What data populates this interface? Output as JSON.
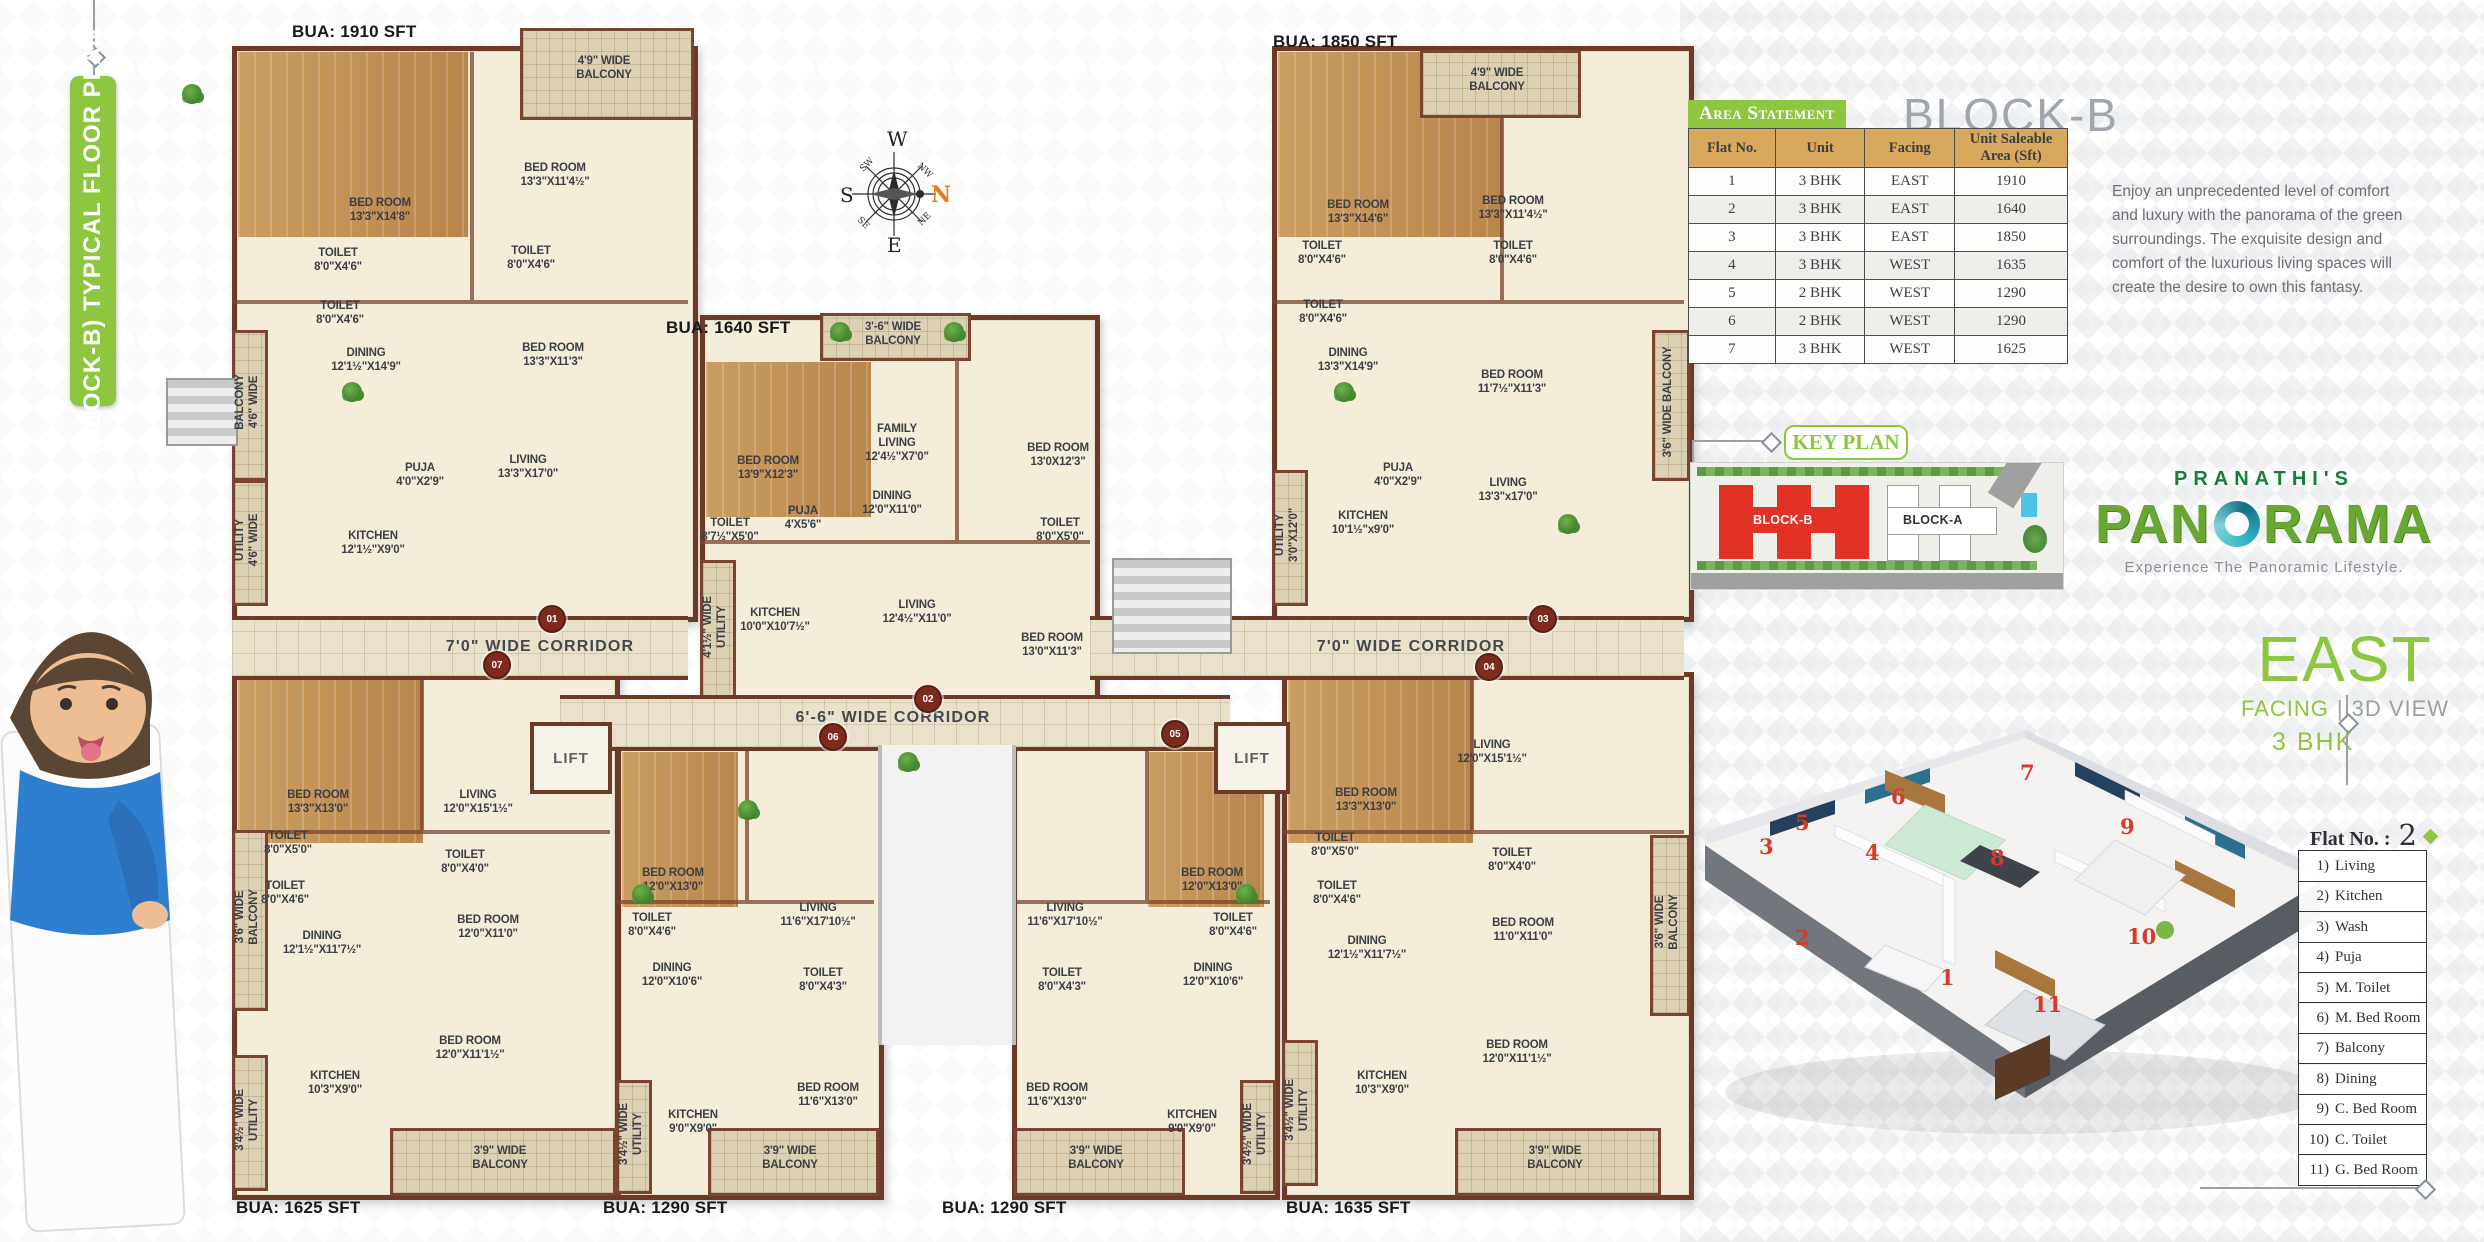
{
  "colors": {
    "accent_green": "#8dc63f",
    "brand_green": "#177e3e",
    "block_red": "#e23125",
    "table_header_tan": "#d8a85c"
  },
  "left_banner": {
    "title": "(BLOCK-B) TYPICAL FLOOR PLAN"
  },
  "compass": {
    "n": "N",
    "s": "S",
    "e": "E",
    "w": "W",
    "nw": "NW",
    "ne": "NE",
    "sw": "SW",
    "se": "SE"
  },
  "floor_plan": {
    "corridors": [
      "7'0\" WIDE CORRIDOR",
      "6'-6\" WIDE CORRIDOR",
      "7'0\" WIDE CORRIDOR"
    ],
    "lift": "LIFT",
    "door_markers": [
      "01",
      "02",
      "03",
      "04",
      "05",
      "06",
      "07"
    ],
    "flats": [
      {
        "bua": "BUA: 1910 SFT",
        "rooms": [
          "4'9\" WIDE\nBALCONY",
          "BED ROOM\n13'3\"X14'8\"",
          "BED ROOM\n13'3\"X11'4½\"",
          "TOILET\n8'0\"X4'6\"",
          "TOILET\n8'0\"X4'6\"",
          "TOILET\n8'0\"X4'6\"",
          "BED ROOM\n13'3\"X11'3\"",
          "DINING\n12'1½\"X14'9\"",
          "BALCONY\n4'6\" WIDE",
          "PUJA\n4'0\"X2'9\"",
          "LIVING\n13'3\"X17'0\"",
          "KITCHEN\n12'1½\"X9'0\"",
          "UTILITY\n4'6\" WIDE"
        ]
      },
      {
        "bua": "BUA: 1640 SFT",
        "rooms": [
          "3'-6\" WIDE\nBALCONY",
          "BED ROOM\n13'9\"X12'3\"",
          "FAMILY\nLIVING\n12'4½\"X7'0\"",
          "BED ROOM\n13'0X12'3\"",
          "TOILET\n8'7½\"X5'0\"",
          "PUJA\n4'X5'6\"",
          "DINING\n12'0\"X11'0\"",
          "TOILET\n8'0\"X5'0\"",
          "KITCHEN\n10'0\"X10'7½\"",
          "4'1½\" WIDE\nUTILITY",
          "LIVING\n12'4½\"X11'0\"",
          "BED ROOM\n13'0\"X11'3\""
        ]
      },
      {
        "bua": "BUA: 1850 SFT",
        "rooms": [
          "4'9\" WIDE\nBALCONY",
          "BED ROOM\n13'3\"X14'6\"",
          "BED ROOM\n13'3\"X11'4½\"",
          "TOILET\n8'0\"X4'6\"",
          "TOILET\n8'0\"X4'6\"",
          "TOILET\n8'0\"X4'6\"",
          "BED ROOM\n11'7½\"X11'3\"",
          "DINING\n13'3\"X14'9\"",
          "3'6\" WIDE BALCONY",
          "PUJA\n4'0\"X2'9\"",
          "LIVING\n13'3\"x17'0\"",
          "KITCHEN\n10'1½\"x9'0\"",
          "UTILITY\n3'0\"X12'0\""
        ]
      },
      {
        "bua": "BUA: 1635 SFT",
        "rooms": [
          "BED ROOM\n13'3\"X13'0\"",
          "LIVING\n12'0\"X15'1½\"",
          "TOILET\n8'0\"X5'0\"",
          "TOILET\n8'0\"X4'6\"",
          "TOILET\n8'0\"X4'0\"",
          "BED ROOM\n11'0\"X11'0\"",
          "3'6\" WIDE\nBALCONY",
          "DINING\n12'1½\"X11'7½\"",
          "BED ROOM\n12'0\"X11'1½\"",
          "KITCHEN\n10'3\"X9'0\"",
          "3'4½\" WIDE\nUTILITY",
          "3'9\" WIDE\nBALCONY"
        ]
      },
      {
        "bua": "BUA: 1290 SFT",
        "rooms": [
          "BED ROOM\n12'0\"X13'0\"",
          "LIVING\n11'6\"X17'10½\"",
          "TOILET\n8'0\"X4'6\"",
          "DINING\n12'0\"X10'6\"",
          "TOILET\n8'0\"X4'3\"",
          "BED ROOM\n11'6\"X13'0\"",
          "KITCHEN\n9'0\"X9'0\"",
          "3'4½\" WIDE\nUTILITY",
          "3'9\" WIDE\nBALCONY"
        ]
      },
      {
        "bua": "BUA: 1290 SFT",
        "rooms": [
          "BED ROOM\n12'0\"X13'0\"",
          "LIVING\n11'6\"X17'10½\"",
          "TOILET\n8'0\"X4'6\"",
          "DINING\n12'0\"X10'6\"",
          "TOILET\n8'0\"X4'3\"",
          "BED ROOM\n11'6\"X13'0\"",
          "KITCHEN\n9'0\"X9'0\"",
          "3'4½\" WIDE\nUTILITY",
          "3'9\" WIDE\nBALCONY"
        ]
      },
      {
        "bua": "BUA: 1625 SFT",
        "rooms": [
          "BED ROOM\n13'3\"X13'0\"",
          "LIVING\n12'0\"X15'1½\"",
          "TOILET\n8'0\"X5'0\"",
          "TOILET\n8'0\"X4'6\"",
          "TOILET\n8'0\"X4'0\"",
          "BED ROOM\n12'0\"X11'0\"",
          "DINING\n12'1½\"X11'7½\"",
          "BED ROOM\n12'0\"X11'1½\"",
          "KITCHEN\n10'3\"X9'0\"",
          "3'4½\" WIDE\nUTILITY",
          "3'6\" WIDE\nBALCONY",
          "3'9\" WIDE\nBALCONY"
        ]
      }
    ]
  },
  "area_statement": {
    "title": "Area Statement",
    "block_title": "BLOCK-B",
    "headers": [
      "Flat No.",
      "Unit",
      "Facing",
      "Unit Saleable\nArea (Sft)"
    ],
    "rows": [
      [
        "1",
        "3 BHK",
        "EAST",
        "1910"
      ],
      [
        "2",
        "3 BHK",
        "EAST",
        "1640"
      ],
      [
        "3",
        "3 BHK",
        "EAST",
        "1850"
      ],
      [
        "4",
        "3 BHK",
        "WEST",
        "1635"
      ],
      [
        "5",
        "2 BHK",
        "WEST",
        "1290"
      ],
      [
        "6",
        "2 BHK",
        "WEST",
        "1290"
      ],
      [
        "7",
        "3 BHK",
        "WEST",
        "1625"
      ]
    ]
  },
  "description": "Enjoy an unprecedented level of comfort and luxury with the panorama of the green surroundings. The exquisite design and comfort of the luxurious living spaces will create the desire to own this fantasy.",
  "key_plan": {
    "label": "KEY PLAN",
    "block_b": "BLOCK-B",
    "block_a": "BLOCK-A"
  },
  "logo": {
    "brand": "PRANATHI'S",
    "name_left": "PAN",
    "name_right": "RAMA",
    "tagline": "Experience The Panoramic Lifestyle."
  },
  "view3d": {
    "heading": "EAST",
    "sub_left": "FACING",
    "sub_divider": "|",
    "sub_right": "3D VIEW",
    "bhk": "3 BHK",
    "markers": [
      "1",
      "2",
      "3",
      "4",
      "5",
      "6",
      "7",
      "8",
      "9",
      "10",
      "11"
    ]
  },
  "flat_legend": {
    "title": "Flat No. :",
    "number": "2",
    "items": [
      {
        "no": "1)",
        "label": "Living"
      },
      {
        "no": "2)",
        "label": "Kitchen"
      },
      {
        "no": "3)",
        "label": "Wash"
      },
      {
        "no": "4)",
        "label": "Puja"
      },
      {
        "no": "5)",
        "label": "M. Toilet"
      },
      {
        "no": "6)",
        "label": "M. Bed Room"
      },
      {
        "no": "7)",
        "label": "Balcony"
      },
      {
        "no": "8)",
        "label": "Dining"
      },
      {
        "no": "9)",
        "label": "C. Bed Room"
      },
      {
        "no": "10)",
        "label": "C. Toilet"
      },
      {
        "no": "11)",
        "label": "G. Bed Room"
      }
    ]
  }
}
